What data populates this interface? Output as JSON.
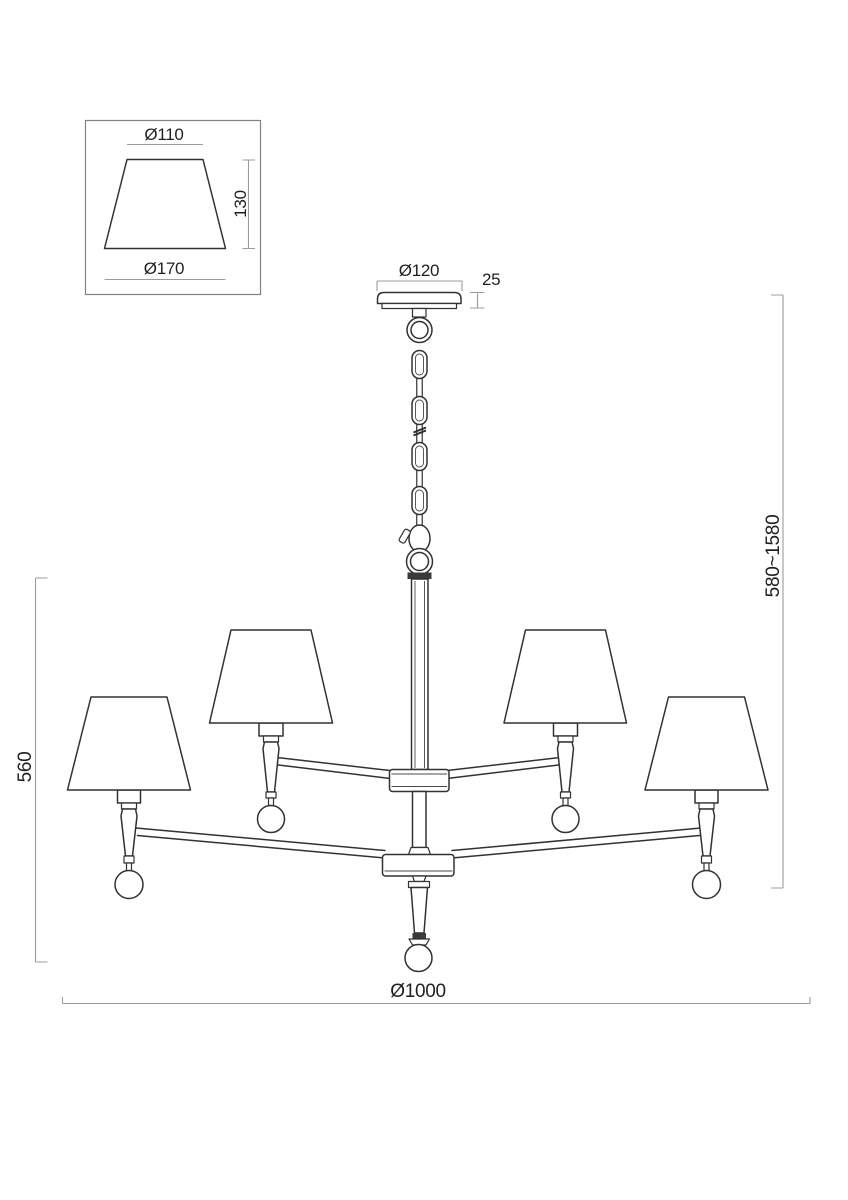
{
  "detail_view": {
    "top_diameter_label": "Ø110",
    "height_label": "130",
    "bottom_diameter_label": "Ø170"
  },
  "main_view": {
    "canopy_diameter_label": "Ø120",
    "canopy_height_label": "25",
    "suspension_range_label": "580~1580",
    "body_height_label": "560",
    "overall_diameter_label": "Ø1000"
  },
  "colors": {
    "outline": "#323232",
    "dimension_line": "#9c9c9c",
    "text": "#1f1f1f",
    "background": "#ffffff"
  }
}
